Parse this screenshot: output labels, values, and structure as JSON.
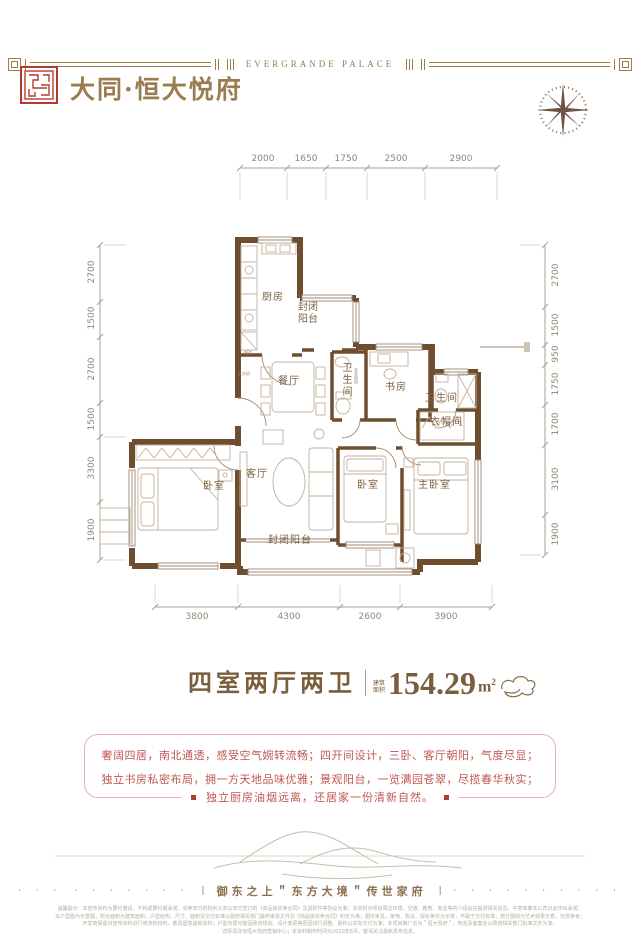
{
  "colors": {
    "brand_gold": "#9b7c50",
    "seal_red": "#b6392f",
    "wall_brown": "#6f4e2f",
    "highlight_red": "#c1574f",
    "accent_square_red": "#ae3f37"
  },
  "header": {
    "banner_text": "EVERGRANDE PALACE",
    "brand_title": "大同·恒大悦府"
  },
  "floorplan": {
    "dims_top": [
      "2000",
      "1650",
      "1750",
      "2500",
      "2900"
    ],
    "dims_left": [
      "2700",
      "1500",
      "2700",
      "1500",
      "3300",
      "1900"
    ],
    "dims_right": [
      "2700",
      "1500",
      "950",
      "1750",
      "1700",
      "3100",
      "1900"
    ],
    "dims_bottom": [
      "3800",
      "4300",
      "2600",
      "3900"
    ],
    "rooms": {
      "kitchen": "厨房",
      "balcony_top": "封闭阳台",
      "dining": "餐厅",
      "bath1": "卫生间",
      "bath1_note": "安全使用",
      "study": "书房",
      "bath2": "卫生间",
      "closet": "衣帽间",
      "bedroom_left": "卧室",
      "living": "客厅",
      "bedroom_mid": "卧室",
      "master": "主卧室",
      "balcony_bottom": "封闭阳台",
      "flue_note": "烟道",
      "water_note": "饮水机"
    }
  },
  "unit_info": {
    "layout_title": "四室两厅两卫",
    "area_label_top": "建筑",
    "area_label_bottom": "面积",
    "area_value": "154.29",
    "area_unit_base": "m",
    "area_unit_exp": "2"
  },
  "description": {
    "line1": "奢阔四居，南北通透，感受空气婉转流畅；四开间设计，三卧、客厅朝阳，气度尽显；",
    "line2": "独立书房私密布局，拥一方天地品味优雅；景观阳台，一览满园苍翠，尽揽春华秋实；",
    "line3": "独立厨房油烟远离，还居家一份清新自然。"
  },
  "footer": {
    "dots_a": "· · ·",
    "dots_b": "· · · · · · ·",
    "bar": "|",
    "slogan": "御东之上＂东方大境＂传世家府",
    "dots_c": "· · · · · · · · · ·",
    "disclaimer_lines": [
      "温馨提示：本宣传资料为要约邀请，不构成要约或承诺，买卖双方的权利义务以双方签订的《商品房买卖合同》及其附件等协议为准；本资料对项目周边环境、交通、教育、商业等的介绍旨在提供相关信息，不意味着本公司对此作出承诺；",
      "本户型图为示意图，所示面积为建筑面积，户型结构、尺寸、面积及交付标准以政府相关部门最终审批文件及《商品房买卖合同》约定为准；图中家具、家电、陈设、绿化等仅为示意，不属于交付标准；部分图例为艺术效果示意，仅供参考；",
      "开发商保留对宣传资料进行修改的权利，敬请留意最新资料；户型布局可能因政府规划、设计变更等原因进行调整，最终以实际交付为准；本项目推广名为＂恒大悦府＂，地名及备案名以政府相关部门批准文件为准；",
      "详情请详询恒大悦府营销中心；本资料制作时间为2020年8月，敬请关注最新发布信息。"
    ]
  }
}
